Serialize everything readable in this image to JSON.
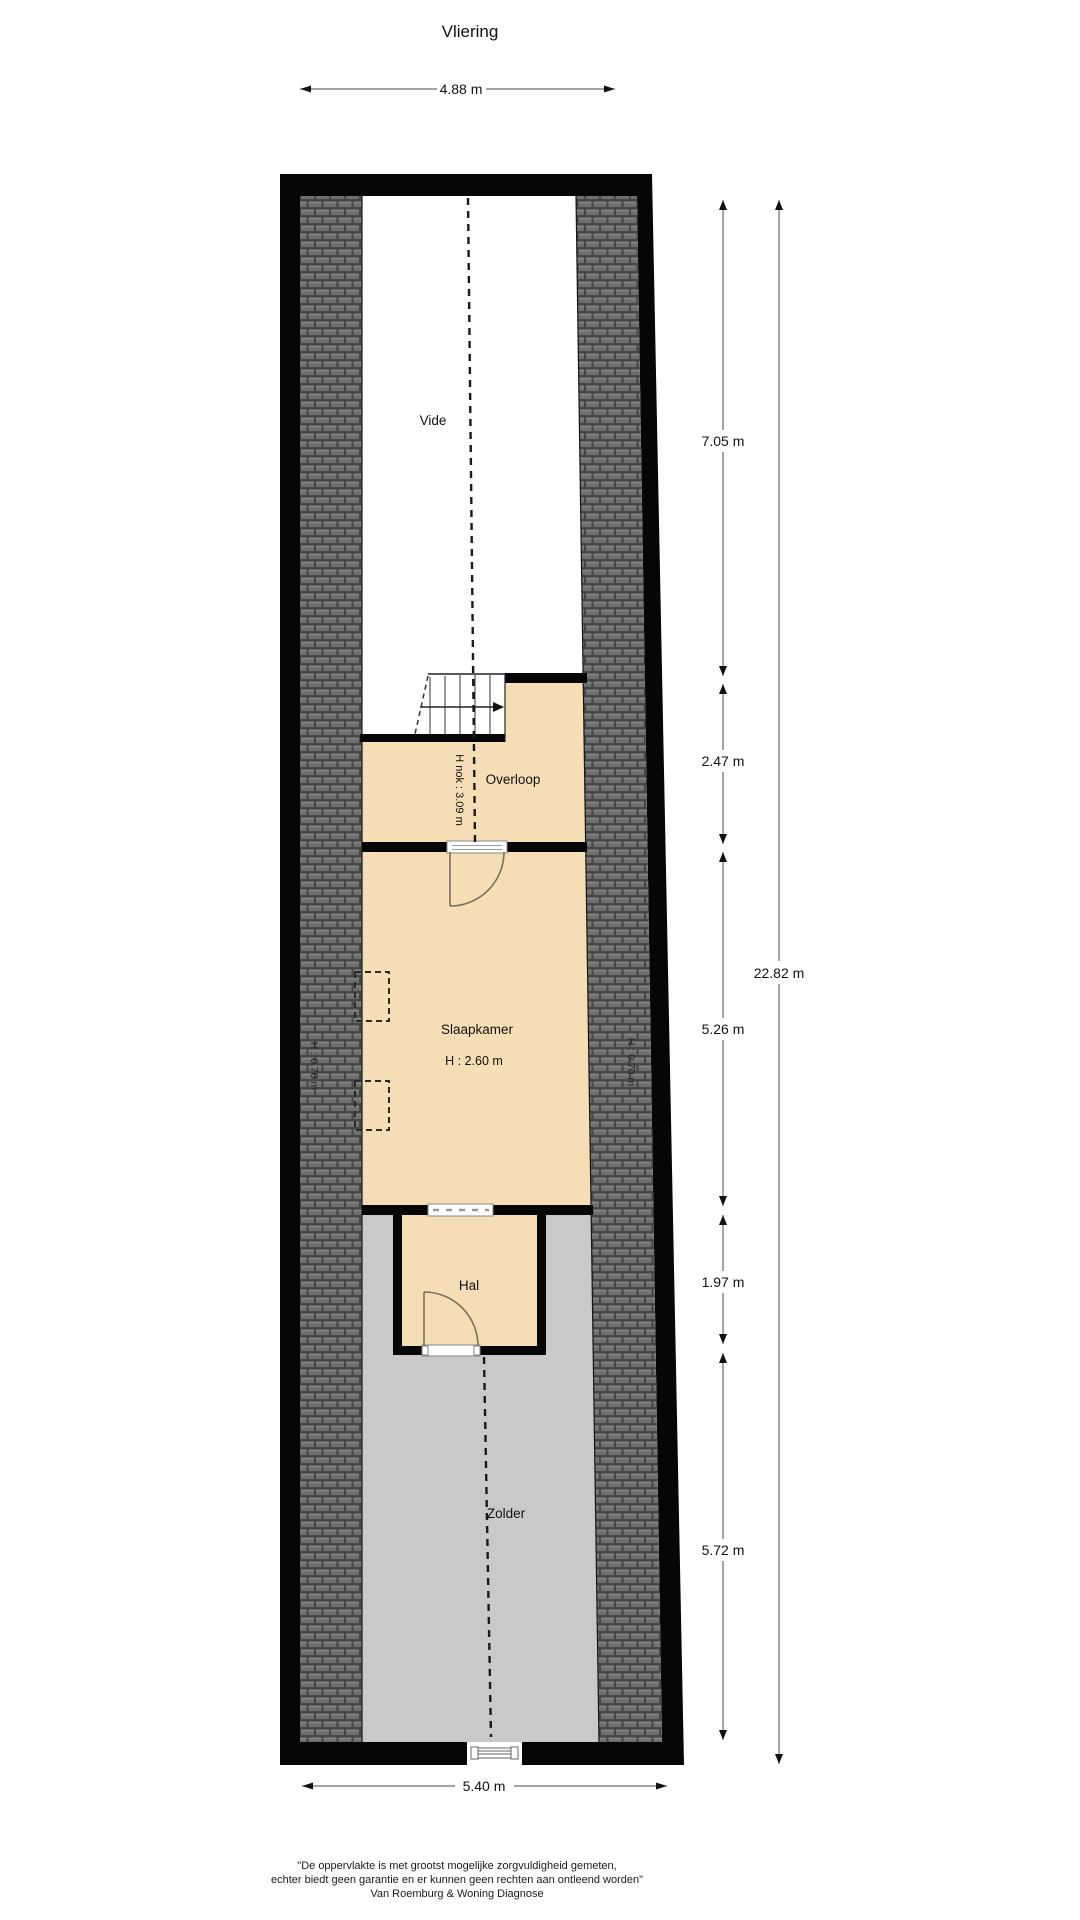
{
  "title": "Vliering",
  "colors": {
    "room_fill": "#F5DEB5",
    "attic_fill": "#C9C9C9",
    "wall": "#060606",
    "roof_tile": "#6E6E6E",
    "roof_joint": "#474747",
    "dimension_line": "#4A4A4A",
    "text": "#111111"
  },
  "rooms": {
    "vide": {
      "label": "Vide"
    },
    "overloop": {
      "label": "Overloop",
      "ridge_height": "H nok : 3.09 m"
    },
    "slaapkamer": {
      "label": "Slaapkamer",
      "ceiling_height": "H : 2.60 m"
    },
    "hal": {
      "label": "Hal"
    },
    "zolder": {
      "label": "Zolder"
    },
    "knee_wall_left": "H : 0.70 m",
    "knee_wall_right": "H : 0.70 m"
  },
  "dimensions": {
    "top_width": "4.88 m",
    "bottom_width": "5.40 m",
    "total_height": "22.82 m",
    "segments": [
      "7.05 m",
      "2.47 m",
      "5.26 m",
      "1.97 m",
      "5.72 m"
    ]
  },
  "footer": {
    "line1": "\"De oppervlakte is met grootst mogelijke zorgvuldigheid gemeten,",
    "line2": "echter biedt geen garantie en er kunnen geen rechten aan ontleend worden\"",
    "line3": "Van Roemburg & Woning Diagnose"
  }
}
